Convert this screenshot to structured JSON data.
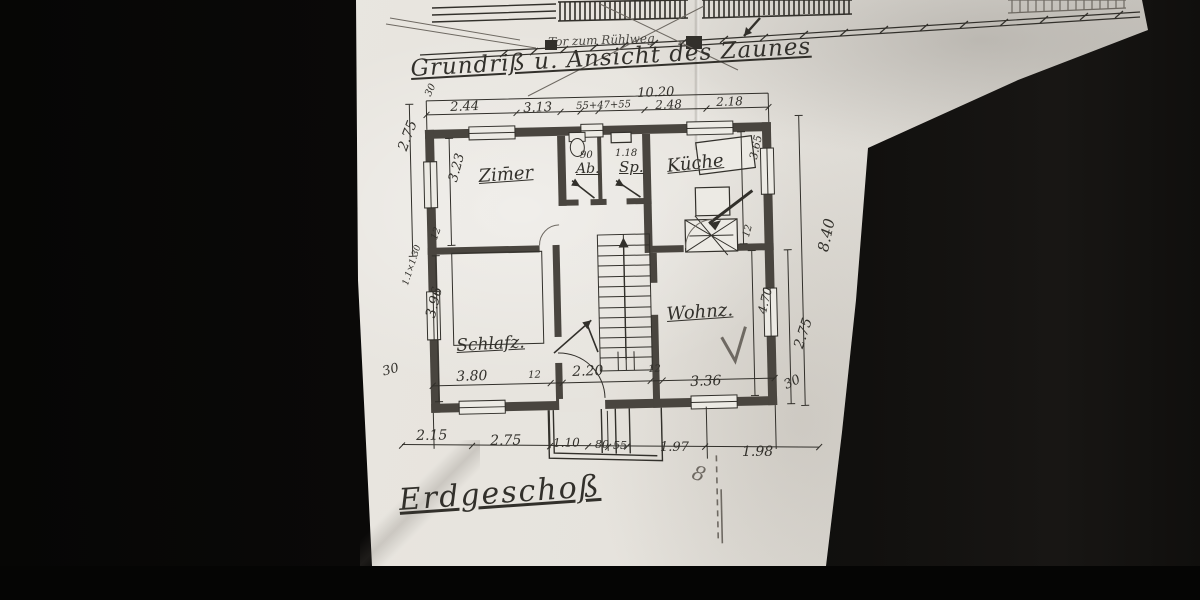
{
  "colors": {
    "ink": "#32302b",
    "pencil": "#6e6962",
    "wall": "#49453f",
    "paperlite": "#eceae4"
  },
  "header": {
    "gate_note": "Tor zum Rühlweg.",
    "title": "Grundriß u. Ansicht des Zaunes"
  },
  "floor_label": "Erdgeschoß",
  "rooms": {
    "zimmer": "Zim̄er",
    "abort": "Ab.",
    "speis": "Sp.",
    "kueche": "Küche",
    "schlafzimmer": "Schlafz.",
    "wohnzimmer": "Wohnz."
  },
  "dims": {
    "top": {
      "wall": "30",
      "overall": "10.20",
      "s1": "2.44",
      "s2": "3.13",
      "s3": "55+47+55",
      "s4": "2.48",
      "s5": "2.18"
    },
    "small_rooms": {
      "ab_width": "90",
      "sp_width": "1.18"
    },
    "left": {
      "upper": "2.75",
      "zimmer_h": "3.23",
      "wall12": "12",
      "window_note": "1.1×1.30",
      "schlaf_h": "3.96",
      "wall30": "30"
    },
    "right": {
      "kueche_h": "3.65",
      "wall12": "12",
      "overall": "8.40",
      "wohnz_h": "4.70",
      "lower": "2.75",
      "wall30": "30"
    },
    "inner_bottom": {
      "s1": "3.80",
      "w1": "12",
      "s2": "2.20",
      "w2": "12",
      "s3": "3.36"
    },
    "outer_bottom": {
      "s1": "2.15",
      "s2": "2.75",
      "s3": "1.10",
      "s4": "80",
      "s5": "55",
      "s6": "1.97",
      "s7": "1.98"
    },
    "marks": {
      "door_mark": "8"
    }
  }
}
